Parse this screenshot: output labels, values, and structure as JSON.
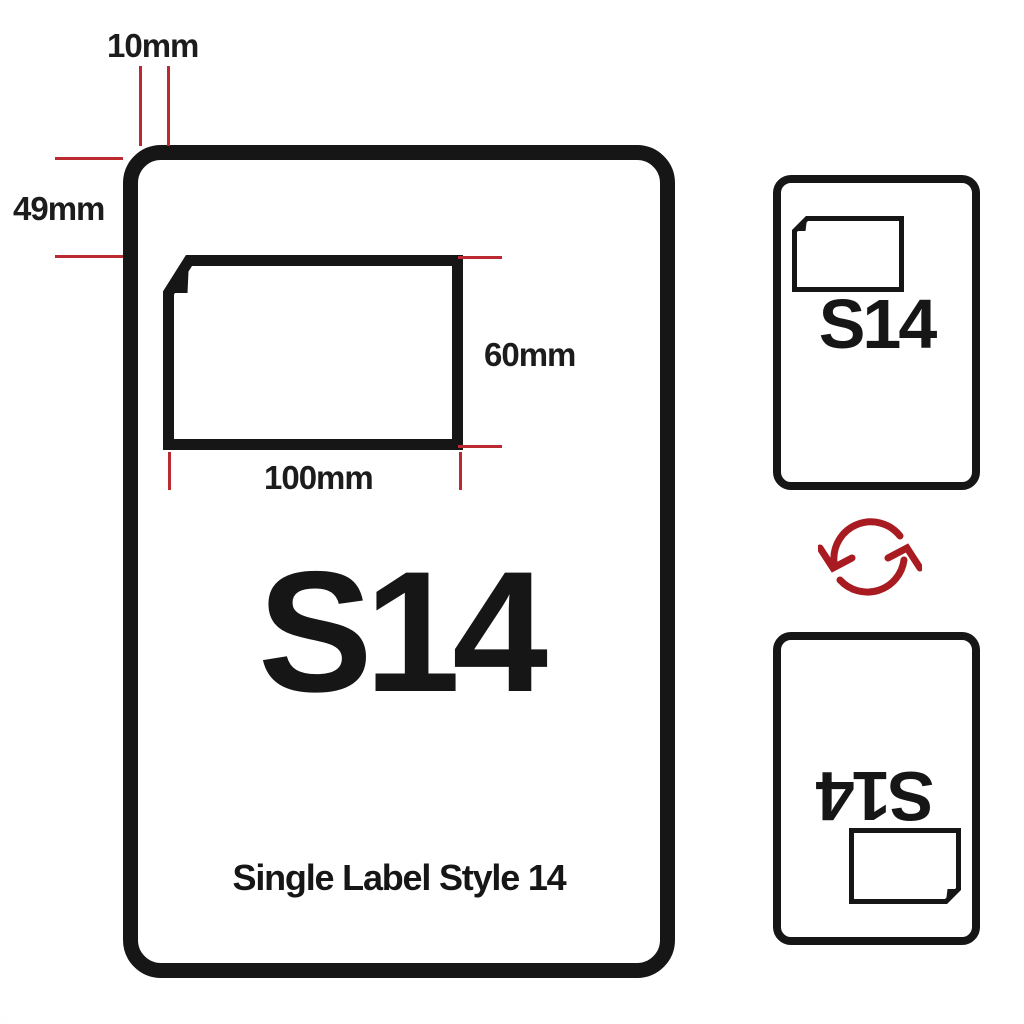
{
  "colors": {
    "ink": "#161616",
    "dimension_red": "#bb2a30",
    "rotate_red": "#a81b20"
  },
  "diagram": {
    "sheet": {
      "code": "S14",
      "caption": "Single Label Style 14"
    },
    "dimensions": {
      "offset_left": "10mm",
      "offset_top": "49mm",
      "label_height": "60mm",
      "label_width": "100mm"
    },
    "preview_front": {
      "code": "S14"
    },
    "preview_back": {
      "code": "S14"
    },
    "icons": {
      "rotate": "rotate-arrows-icon"
    }
  }
}
